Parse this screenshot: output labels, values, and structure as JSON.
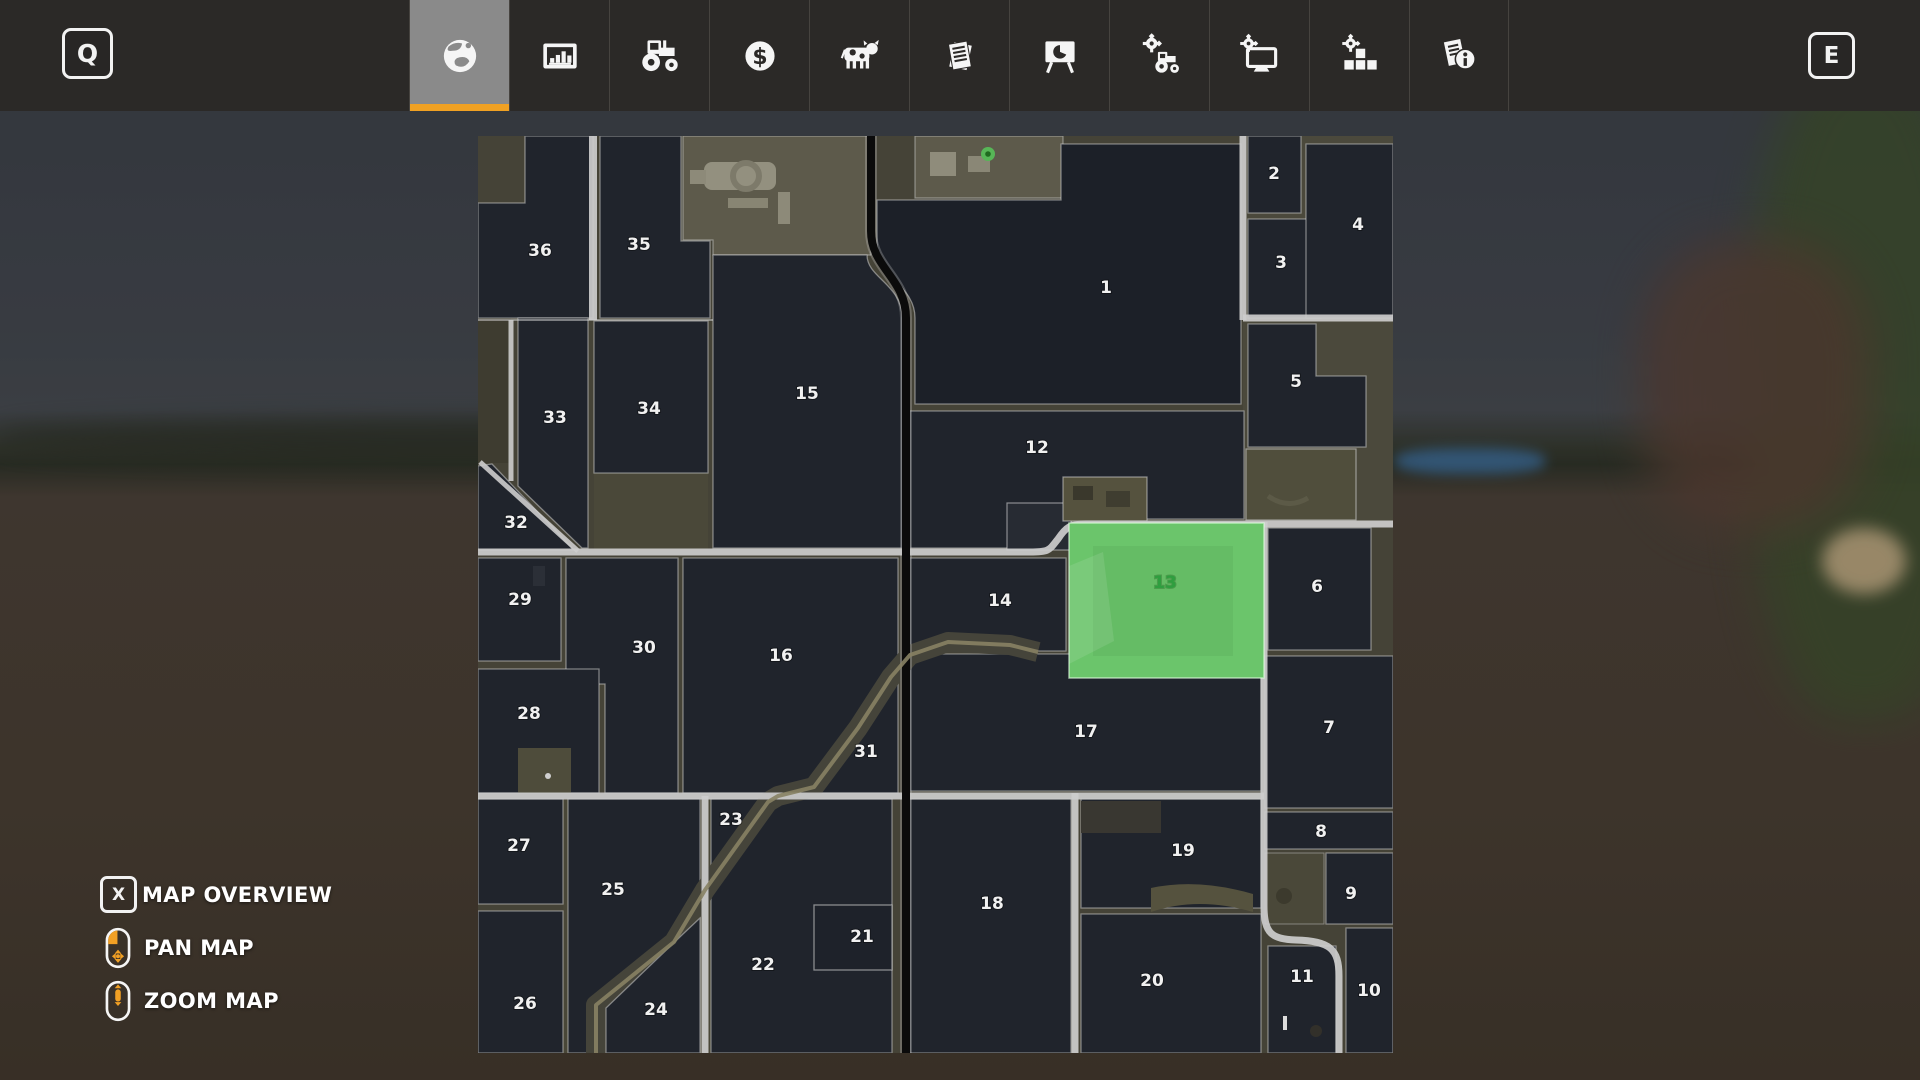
{
  "toolbar": {
    "left_key": "Q",
    "right_key": "E",
    "accent_color": "#f0a123",
    "tabs": [
      {
        "icon": "map-globe-icon",
        "selected": true
      },
      {
        "icon": "statistics-chart-icon",
        "selected": false
      },
      {
        "icon": "garage-tractor-icon",
        "selected": false
      },
      {
        "icon": "finances-dollar-icon",
        "selected": false
      },
      {
        "icon": "animals-cow-icon",
        "selected": false
      },
      {
        "icon": "contracts-papers-icon",
        "selected": false
      },
      {
        "icon": "production-board-icon",
        "selected": false
      },
      {
        "icon": "vehicle-maintenance-icon",
        "selected": false
      },
      {
        "icon": "general-settings-icon",
        "selected": false
      },
      {
        "icon": "game-settings-icon",
        "selected": false
      },
      {
        "icon": "help-info-icon",
        "selected": false
      }
    ]
  },
  "legend": {
    "items": [
      {
        "key": "X",
        "label": "MAP OVERVIEW"
      },
      {
        "mouse": "pan",
        "label": "PAN MAP"
      },
      {
        "mouse": "zoom",
        "label": "ZOOM MAP"
      }
    ]
  },
  "map": {
    "selected_field": 13,
    "selected_field_color": "#6bc56b",
    "selected_label_color": "#2f9e3f",
    "field_label_color": "#f1f1f1",
    "poi": {
      "type": "green-marker",
      "x": 510,
      "y": 18
    },
    "fields": [
      {
        "n": 1,
        "x": 628,
        "y": 152
      },
      {
        "n": 2,
        "x": 796,
        "y": 38
      },
      {
        "n": 3,
        "x": 803,
        "y": 127
      },
      {
        "n": 4,
        "x": 880,
        "y": 89
      },
      {
        "n": 5,
        "x": 818,
        "y": 246
      },
      {
        "n": 6,
        "x": 839,
        "y": 451
      },
      {
        "n": 7,
        "x": 851,
        "y": 592
      },
      {
        "n": 8,
        "x": 843,
        "y": 696
      },
      {
        "n": 9,
        "x": 873,
        "y": 758
      },
      {
        "n": 10,
        "x": 891,
        "y": 855
      },
      {
        "n": 11,
        "x": 824,
        "y": 841
      },
      {
        "n": 12,
        "x": 559,
        "y": 312
      },
      {
        "n": 13,
        "x": 687,
        "y": 447
      },
      {
        "n": 14,
        "x": 522,
        "y": 465
      },
      {
        "n": 15,
        "x": 329,
        "y": 258
      },
      {
        "n": 16,
        "x": 303,
        "y": 520
      },
      {
        "n": 17,
        "x": 608,
        "y": 596
      },
      {
        "n": 18,
        "x": 514,
        "y": 768
      },
      {
        "n": 19,
        "x": 705,
        "y": 715
      },
      {
        "n": 20,
        "x": 674,
        "y": 845
      },
      {
        "n": 21,
        "x": 384,
        "y": 801
      },
      {
        "n": 22,
        "x": 285,
        "y": 829
      },
      {
        "n": 23,
        "x": 253,
        "y": 684
      },
      {
        "n": 24,
        "x": 178,
        "y": 874
      },
      {
        "n": 25,
        "x": 135,
        "y": 754
      },
      {
        "n": 26,
        "x": 47,
        "y": 868
      },
      {
        "n": 27,
        "x": 41,
        "y": 710
      },
      {
        "n": 28,
        "x": 51,
        "y": 578
      },
      {
        "n": 29,
        "x": 42,
        "y": 464
      },
      {
        "n": 30,
        "x": 166,
        "y": 512
      },
      {
        "n": 31,
        "x": 388,
        "y": 616
      },
      {
        "n": 32,
        "x": 38,
        "y": 387
      },
      {
        "n": 33,
        "x": 77,
        "y": 282
      },
      {
        "n": 34,
        "x": 171,
        "y": 273
      },
      {
        "n": 35,
        "x": 161,
        "y": 109
      },
      {
        "n": 36,
        "x": 62,
        "y": 115
      }
    ]
  }
}
